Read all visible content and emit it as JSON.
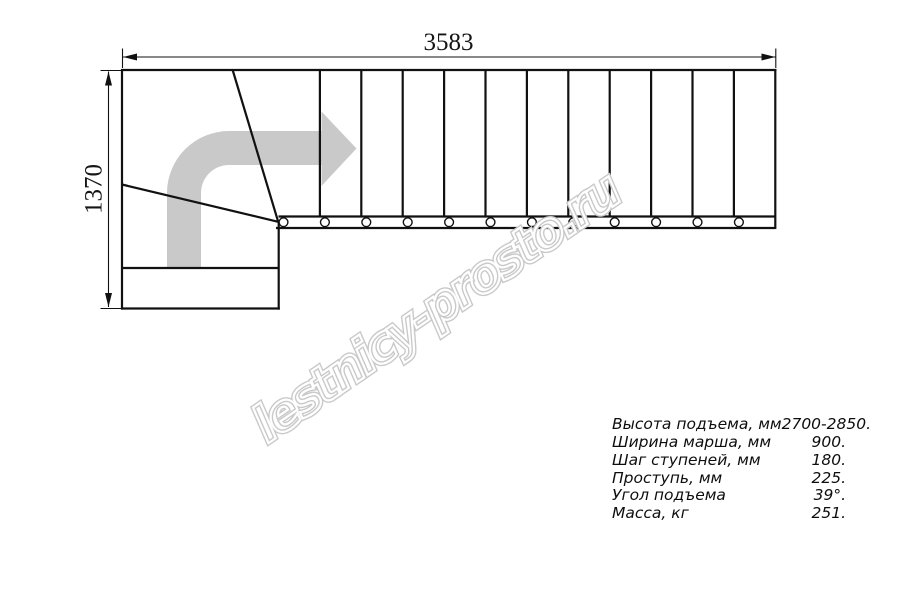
{
  "drawing": {
    "top_dimension": "3583",
    "left_dimension": "1370",
    "straight_flight_steps": 12,
    "baluster_count": 12
  },
  "specs": {
    "rows": [
      {
        "label": "Высота подъема, мм",
        "value": "2700-2850."
      },
      {
        "label": "Ширина марша, мм",
        "value": "900."
      },
      {
        "label": "Шаг ступеней, мм",
        "value": "180."
      },
      {
        "label": "Проступь, мм",
        "value": "225."
      },
      {
        "label": "Угол подъема",
        "value": "39°."
      },
      {
        "label": "Масса, кг",
        "value": "251."
      }
    ]
  },
  "watermark": {
    "text": "lestnicy-prosto.ru"
  },
  "colors": {
    "line": "#111111",
    "direction_arrow": "#c9c9c9",
    "watermark": "#c9c9c9",
    "background": "#ffffff"
  }
}
